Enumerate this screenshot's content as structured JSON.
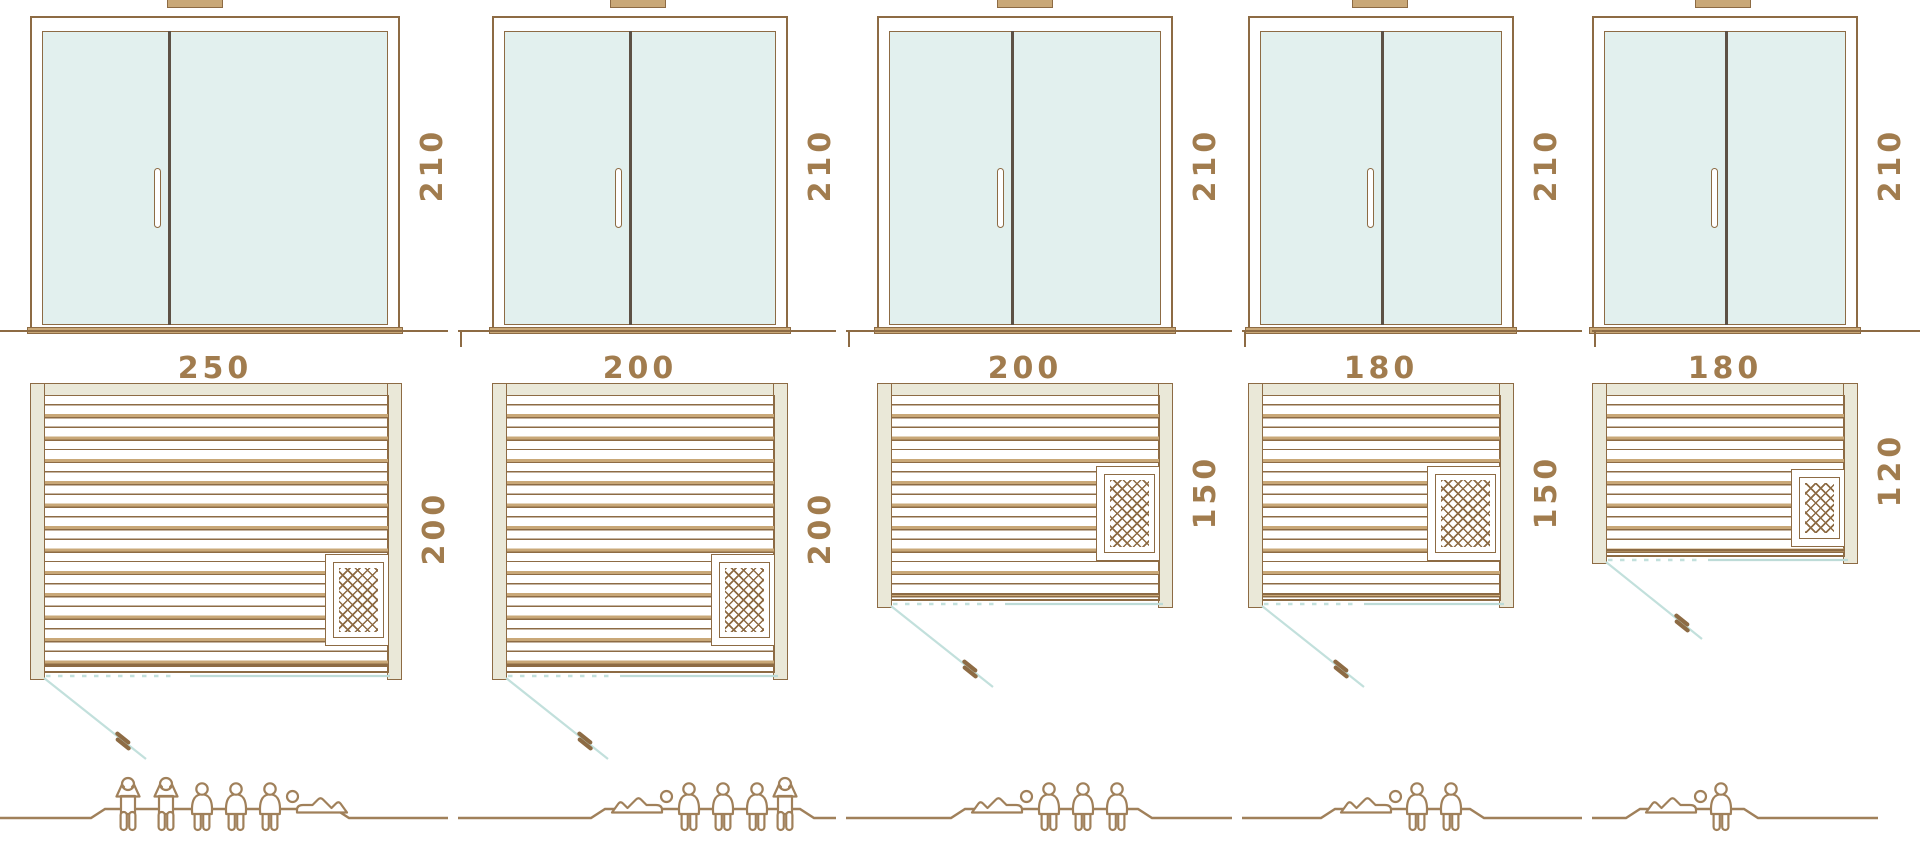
{
  "colors": {
    "line_brown": "#8d6b44",
    "fill_tan": "#c9a878",
    "frame_beige": "#eae8d8",
    "glass_mint": "#e2f0ee",
    "swing_teal": "#c2e0dc",
    "label_brown": "#a17c4e",
    "figure_brown": "#a0805a",
    "door_divider_dark": "#5d5145",
    "background": "#ffffff"
  },
  "icons": [
    "roof-cap",
    "heater-mesh-icon",
    "plan-door-handle-icon",
    "person-standing-icon",
    "person-sitting-icon",
    "person-lying-icon"
  ],
  "models": [
    {
      "width_label": "250",
      "height_label": "210",
      "depth_label": "200",
      "heater_position": "bottom-right",
      "capacity": {
        "standing": 2,
        "sitting": 3,
        "lying": 1,
        "total": 6
      }
    },
    {
      "width_label": "200",
      "height_label": "210",
      "depth_label": "200",
      "heater_position": "bottom-right",
      "capacity": {
        "standing": 1,
        "sitting": 3,
        "lying": 1,
        "total": 5
      }
    },
    {
      "width_label": "200",
      "height_label": "210",
      "depth_label": "150",
      "heater_position": "middle-right",
      "capacity": {
        "standing": 0,
        "sitting": 3,
        "lying": 1,
        "total": 4
      }
    },
    {
      "width_label": "180",
      "height_label": "210",
      "depth_label": "150",
      "heater_position": "middle-right",
      "capacity": {
        "standing": 0,
        "sitting": 2,
        "lying": 1,
        "total": 3
      }
    },
    {
      "width_label": "180",
      "height_label": "210",
      "depth_label": "120",
      "heater_position": "middle-right",
      "capacity": {
        "standing": 0,
        "sitting": 1,
        "lying": 1,
        "total": 2
      }
    }
  ]
}
